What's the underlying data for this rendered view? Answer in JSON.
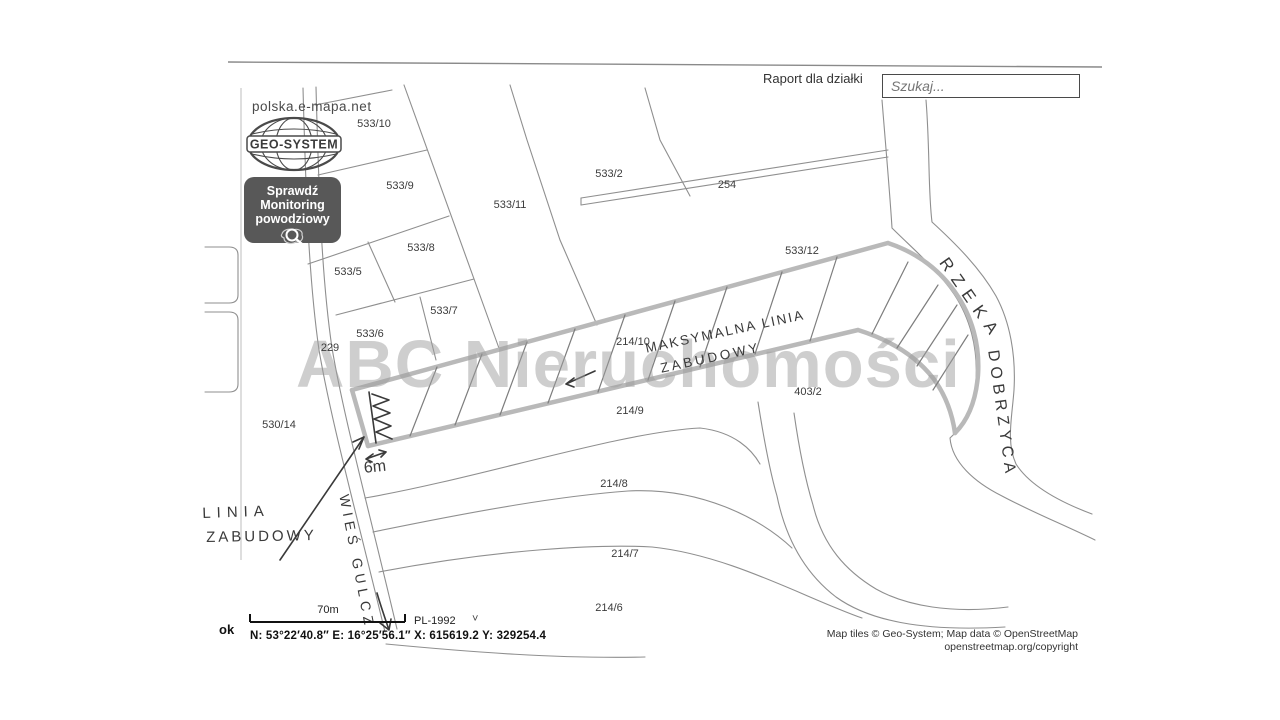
{
  "header": {
    "report_label": "Raport dla działki",
    "search_placeholder": "Szukaj..."
  },
  "branding": {
    "site": "polska.e-mapa.net",
    "logo_text": "GEO-SYSTEM",
    "flood_line1": "Sprawdź",
    "flood_line2": "Monitoring",
    "flood_line3": "powodziowy"
  },
  "map": {
    "watermark": "ABC Nieruchomości",
    "parcel_labels": [
      {
        "label": "533/10",
        "x": 374,
        "y": 124
      },
      {
        "label": "533/9",
        "x": 400,
        "y": 186
      },
      {
        "label": "533/11",
        "x": 510,
        "y": 205
      },
      {
        "label": "533/2",
        "x": 609,
        "y": 174
      },
      {
        "label": "254",
        "x": 727,
        "y": 185
      },
      {
        "label": "533/8",
        "x": 421,
        "y": 248
      },
      {
        "label": "533/5",
        "x": 348,
        "y": 272
      },
      {
        "label": "533/7",
        "x": 444,
        "y": 311
      },
      {
        "label": "533/6",
        "x": 370,
        "y": 334
      },
      {
        "label": "229",
        "x": 330,
        "y": 348
      },
      {
        "label": "533/12",
        "x": 802,
        "y": 251
      },
      {
        "label": "214/10",
        "x": 633,
        "y": 342
      },
      {
        "label": "403/2",
        "x": 808,
        "y": 392
      },
      {
        "label": "214/9",
        "x": 630,
        "y": 411
      },
      {
        "label": "530/14",
        "x": 279,
        "y": 425
      },
      {
        "label": "214/8",
        "x": 614,
        "y": 484
      },
      {
        "label": "214/7",
        "x": 625,
        "y": 554
      },
      {
        "label": "214/6",
        "x": 609,
        "y": 608
      }
    ],
    "annotations": {
      "max_building_line_1": "MAKSYMALNA LINIA",
      "max_building_line_2": "ZABUDOWY",
      "building_line_1": "LINIA",
      "building_line_2": "ZABUDOWY",
      "river_word_1": "RZEKA",
      "river_word_2": "DOBRZYCA",
      "village": "WIEŚ GULCZ",
      "distance": "6m"
    }
  },
  "footer": {
    "ok_label": "ok",
    "scale_label": "70m",
    "crs_label": "PL-1992",
    "crs_chevron": "˅",
    "coordinates": "N: 53°22′40.8″   E: 16°25′56.1″   X: 615619.2   Y: 329254.4",
    "attribution_line1": "Map tiles © Geo-System; Map data © OpenStreetMap",
    "attribution_line2": "openstreetmap.org/copyright"
  },
  "colors": {
    "thin_line": "#8f8f8f",
    "thick_strip_line": "#b9b9b9",
    "handwriting": "#3a3a3a",
    "watermark_gray": "#bdbdbd",
    "badge_bg": "#585858"
  }
}
